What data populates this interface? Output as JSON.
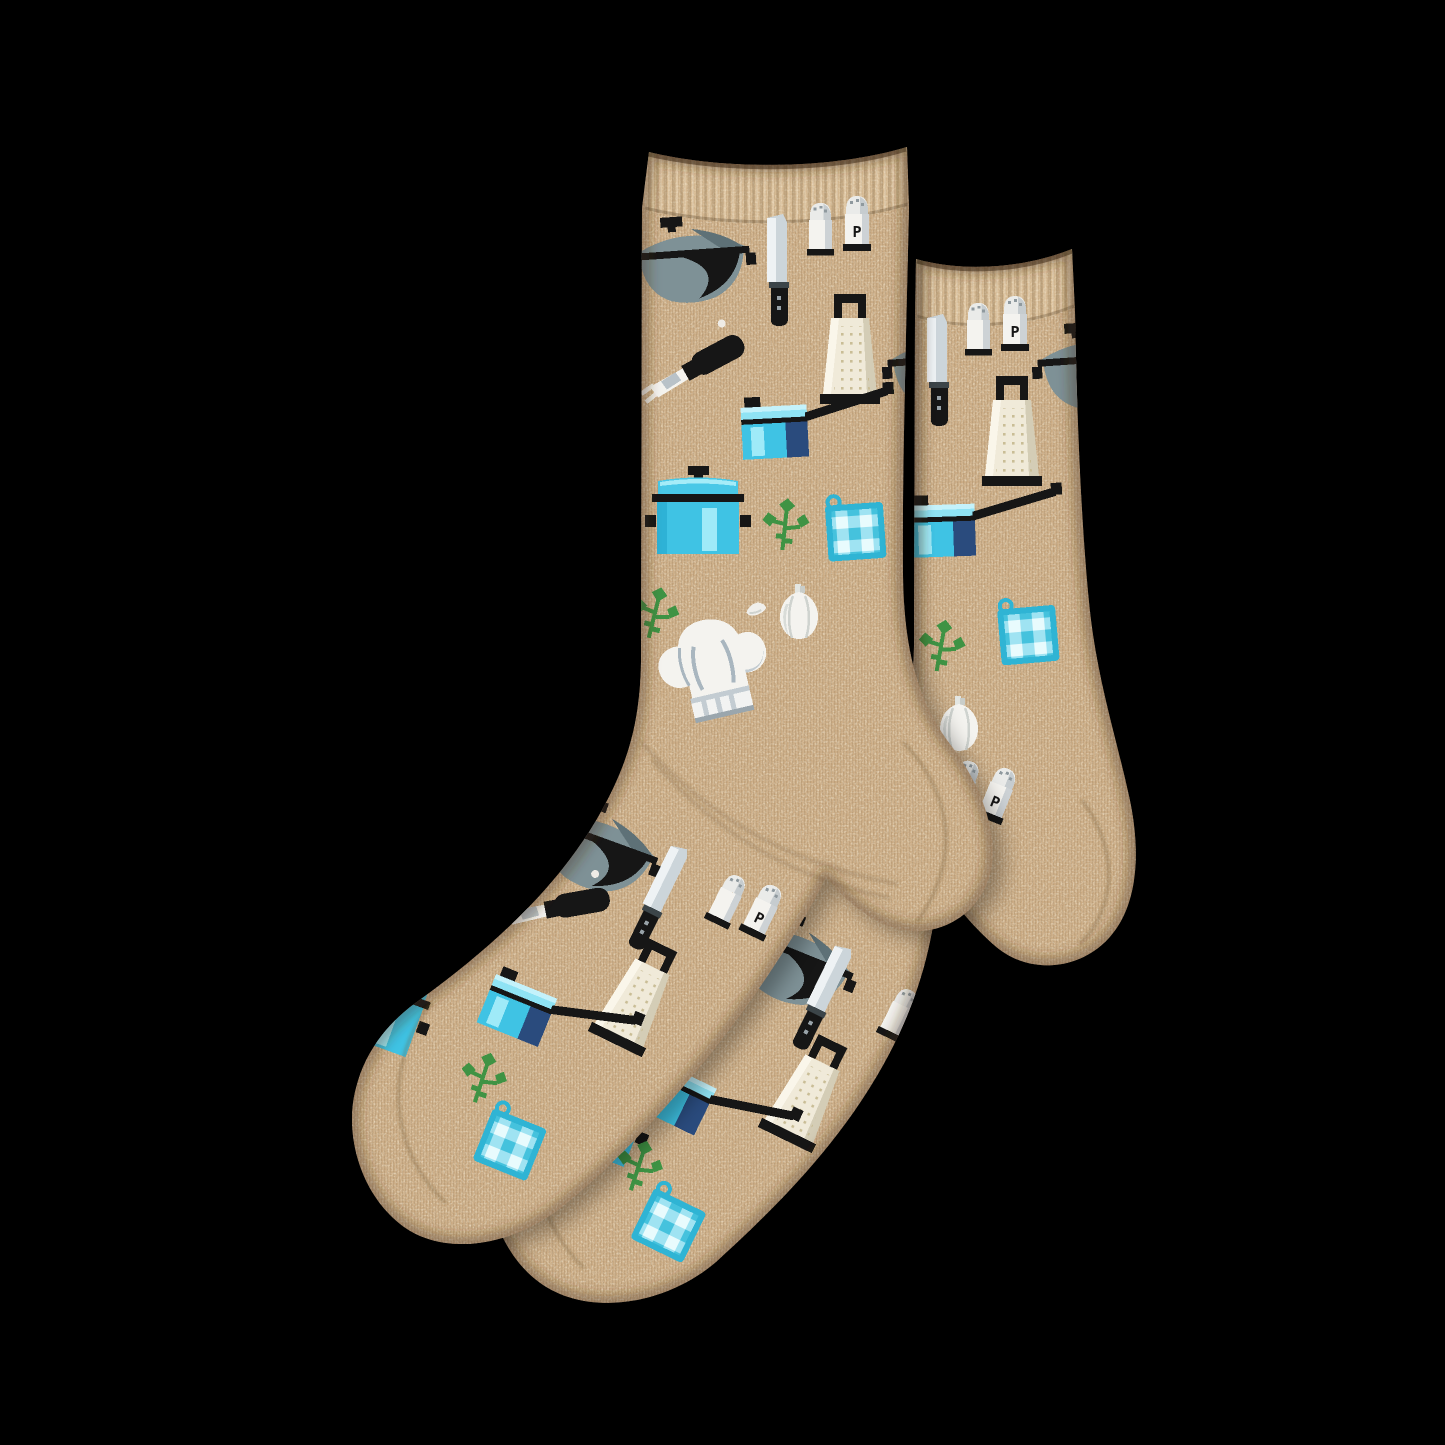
{
  "scene": {
    "type": "product photo",
    "background_color": "#000000",
    "description": "Two overlapping oatmeal-tan heathered crew socks lying flat on a black background, cuffs at the top and toes pointing to the lower left, knitted with an all-over cooking / kitchenware pattern.",
    "visible_text": [
      "P"
    ]
  },
  "product": {
    "item": "crew socks",
    "quantity": 2,
    "base_color_name": "oatmeal heather tan",
    "theme": "chef / cooking kitchenware motifs",
    "knit_style": "pixelated knit motifs, ribbed cuff, plain heel and toe"
  },
  "labels": {
    "pepper_shaker_letter": "P"
  },
  "palette": {
    "background": "#000000",
    "sock_base": "#c9a981",
    "sock_light": "#e6d1ab",
    "sock_dark": "#a8895f",
    "motif_black": "#161616",
    "slate_gray": "#7e9196",
    "slate_dark": "#5e7177",
    "knife_steel": "#ccd5da",
    "white": "#f4f3ef",
    "shade_gray": "#b9c2c8",
    "cream": "#f0ead9",
    "cream_dot": "#c9bd96",
    "pot_cyan": "#3fc3e4",
    "pot_cyan_light": "#9feaf8",
    "lid_cyan": "#49c8e7",
    "navy": "#2a4b7d",
    "gingham_teal": "#2fb4d4",
    "gingham_light": "#9fe3f2",
    "gingham_mid": "#45c2dd",
    "gingham_pale": "#e8fbfd",
    "herb_green": "#3f9344"
  },
  "motifs": [
    {
      "name": "covered pan with lid (wok)",
      "colors": "slate gray with black knob and handles"
    },
    {
      "name": "chef knife",
      "colors": "steel gray blade, black handle"
    },
    {
      "name": "salt and pepper shakers",
      "colors": "white with black base",
      "label_on_pepper": "P"
    },
    {
      "name": "box grater",
      "colors": "cream body, black handle and base"
    },
    {
      "name": "saucepan with long handle",
      "colors": "cyan blue, navy side, black handle"
    },
    {
      "name": "lidded stockpot",
      "colors": "cyan blue with black rim"
    },
    {
      "name": "gingham pot holder with loop",
      "colors": "turquoise, aqua and white checks"
    },
    {
      "name": "parsley sprig",
      "colors": "green"
    },
    {
      "name": "garlic bulb",
      "colors": "white"
    },
    {
      "name": "garlic clove",
      "colors": "white"
    },
    {
      "name": "chef hat",
      "colors": "white with gray shading"
    },
    {
      "name": "fork utensil",
      "colors": "black handle, white head"
    }
  ]
}
